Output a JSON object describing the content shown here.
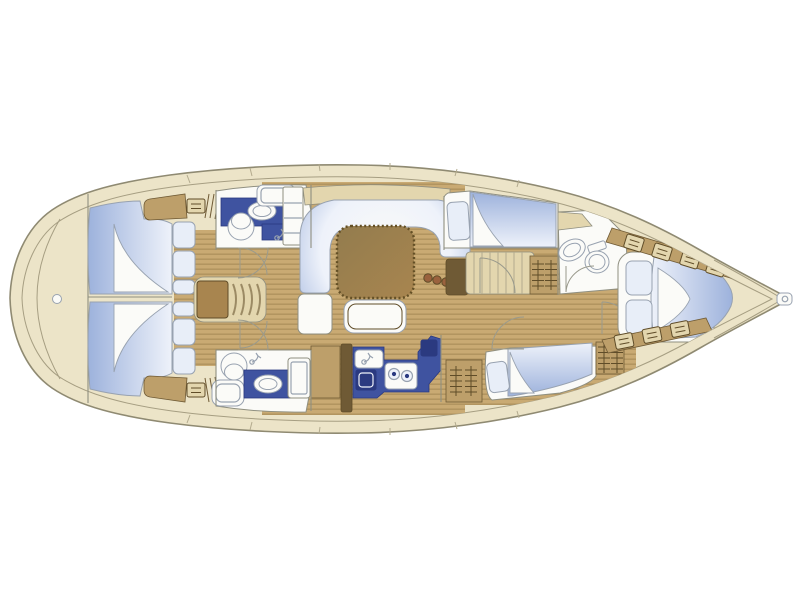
{
  "diagram": {
    "type": "floor-plan",
    "subject": "Sailing yacht interior accommodation plan, top view, bow to the right",
    "orientation": {
      "bow": "right",
      "stern": "left",
      "top_side": "port",
      "bottom_side": "starboard"
    },
    "counts": {
      "cabins": 5,
      "double_berths": 5,
      "heads": 3,
      "stove_burners": 2
    },
    "rooms": {
      "stern_deck": {
        "label": "Stern deck with rounded transom and deck fitting"
      },
      "aft_cabin_port": {
        "label": "Aft double cabin (port): berth, pillows, folded sheet, wardrobe"
      },
      "aft_cabin_stbd": {
        "label": "Aft double cabin (starboard): berth, pillows, folded sheet, wardrobe"
      },
      "companionway": {
        "label": "Companionway steps between the aft cabins"
      },
      "head_port": {
        "label": "Port aft head: shower, wash basin, toilet"
      },
      "head_stbd": {
        "label": "Starboard aft head: shower, wash basin, toilet"
      },
      "saloon": {
        "label": "Saloon: U-shaped settee, dining table, bench seat, shelf"
      },
      "nav_station": {
        "label": "Chart table / navigation locker"
      },
      "galley": {
        "label": "Galley: sink unit, twin sink, 2-burner stove, fridge, lockers"
      },
      "mid_cabin_port": {
        "label": "Port double cabin amidships: berth, pillow, wardrobe"
      },
      "mid_cabin_stbd": {
        "label": "Starboard double cabin amidships: berth, pillow, wardrobe"
      },
      "head_forward": {
        "label": "Forward head: wash basin and toilet"
      },
      "forward_cabin": {
        "label": "Forward owner's cabin: island double berth, two pillows, side shelves"
      },
      "bow_deck": {
        "label": "Bow deck with stem fitting"
      }
    },
    "palette": {
      "background": "#ffffff",
      "hull": "#ece4c8",
      "hull_stroke": "#8f8a72",
      "sheer": "#a69e82",
      "cream": "#e3d6ae",
      "deck_tick": "#b3ab8e",
      "teak": "#c9aa73",
      "teak_stripe": "#a98c58",
      "wood_tan": "#bd9f6a",
      "wood_mid": "#a8854f",
      "wood_dark": "#6f5a35",
      "wood_edge": "#5f4c28",
      "table_wood": "#937c4e",
      "table_edge": "#645026",
      "counter_navy": "#3f53a0",
      "navy_dark": "#2b3a80",
      "berth_deep": "#9db2dc",
      "berth_light": "#eef2fa",
      "pillow": "#e8eef8",
      "room_white": "#fbfbf8",
      "outline": "#8f8f80",
      "fixture_stroke": "#98a2b0",
      "door_stroke": "#9a9a8c",
      "tread": "#9b8a64",
      "cushion_blue": "#c9d6ee",
      "knob_brown": "#9a623e"
    }
  }
}
